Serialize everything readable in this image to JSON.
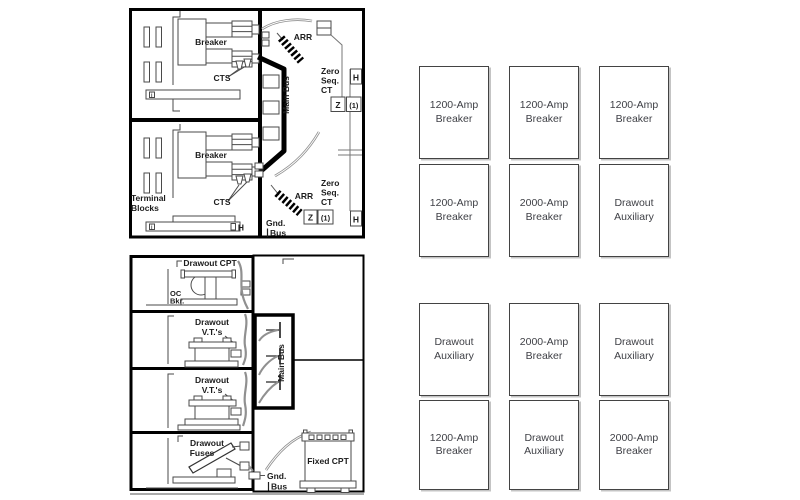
{
  "meta": {
    "description": "Switchgear equipment elevation diagrams with bay arrangement grid",
    "colors": {
      "structure_line": "#000000",
      "equipment_line": "#4a4a4a",
      "cable_gray": "#909090",
      "cell_border": "#434343",
      "cell_text": "#3f4046",
      "cell_shadow": "#c4c4c4",
      "background": "#ffffff"
    }
  },
  "elevation_top": {
    "labels": {
      "breaker": "Breaker",
      "cts": "CTS",
      "arr": "ARR",
      "zero": "Zero",
      "seq": "Seq.",
      "ct": "CT",
      "main_bus": "Main Bus",
      "terminal": "Terminal",
      "blocks": "Blocks",
      "gnd": "Gnd.",
      "bus": "Bus",
      "h": "H",
      "z": "Z",
      "one": "(1)",
      "i": "i"
    }
  },
  "elevation_bottom": {
    "labels": {
      "drawout_cpt": "Drawout CPT",
      "oc": "OC",
      "bkr": "Bkr.",
      "drawout": "Drawout",
      "vts": "V.T.'s",
      "fuses": "Fuses",
      "main_bus": "Main Bus",
      "fixed_cpt": "Fixed CPT",
      "gnd": "Gnd.",
      "bus": "Bus"
    }
  },
  "bay_grid_top": {
    "columns": [
      {
        "top": "1200-Amp Breaker",
        "bottom": "1200-Amp Breaker"
      },
      {
        "top": "1200-Amp Breaker",
        "bottom": "2000-Amp Breaker"
      },
      {
        "top": "1200-Amp Breaker",
        "bottom": "Drawout Auxiliary"
      }
    ]
  },
  "bay_grid_bottom": {
    "columns": [
      {
        "top": "Drawout Auxiliary",
        "bottom": "1200-Amp Breaker"
      },
      {
        "top": "2000-Amp Breaker",
        "bottom": "Drawout Auxiliary"
      },
      {
        "top": "Drawout Auxiliary",
        "bottom": "2000-Amp Breaker"
      }
    ]
  }
}
